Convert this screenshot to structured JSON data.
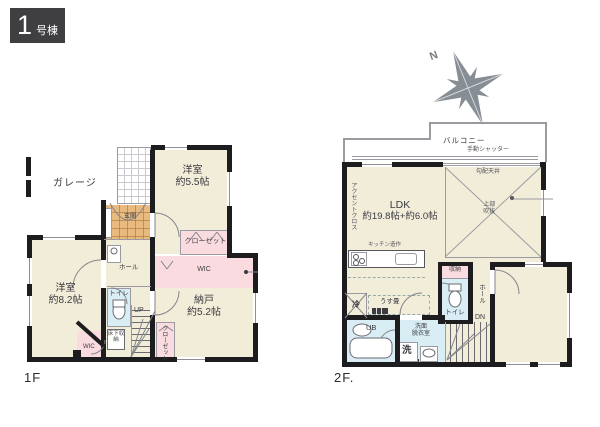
{
  "colors": {
    "wall": "#1d1d20",
    "beige": "#f2edd9",
    "pink": "#fadce0",
    "blue": "#d9edf5",
    "genkan": "#e9ba80",
    "badge": "#3f3f42",
    "compass": "#868d94"
  },
  "badge": {
    "number": "1",
    "suffix": "号棟"
  },
  "compass": {
    "north": "N"
  },
  "floor1": {
    "label": "1F",
    "garage": "ガレージ",
    "genkan": "玄関",
    "hall": "ホール",
    "toilet": "トイレ",
    "up": "UP",
    "underfloor_storage": "床下収納",
    "closet_top": "クローゼット",
    "wic_main": "WIC",
    "closet_stairs": "クローゼット",
    "wic_small": "WIC",
    "rooms": [
      {
        "name": "洋室",
        "size": "約5.5帖"
      },
      {
        "name": "洋室",
        "size": "約8.2帖"
      },
      {
        "name": "納戸",
        "size": "約5.2帖"
      }
    ]
  },
  "floor2": {
    "label": "2F.",
    "balcony": "バルコニー",
    "shutter": "手動シャッター",
    "sloped_ceiling": "勾配天井",
    "open_above": "上部吹抜",
    "accent_cloth": "アクセントクロス",
    "ldk": {
      "name": "LDK",
      "size": "約19.8帖+約6.0帖"
    },
    "kitchen_note": "キッチン造作",
    "fridge": "冷",
    "thin_tatami": "うす畳",
    "unit_bath": "UB",
    "washroom_line1": "洗面",
    "washroom_line2": "脱衣室",
    "washer": "洗",
    "storage": "収納",
    "toilet": "トイレ",
    "hall": "ホール",
    "down": "DN"
  }
}
